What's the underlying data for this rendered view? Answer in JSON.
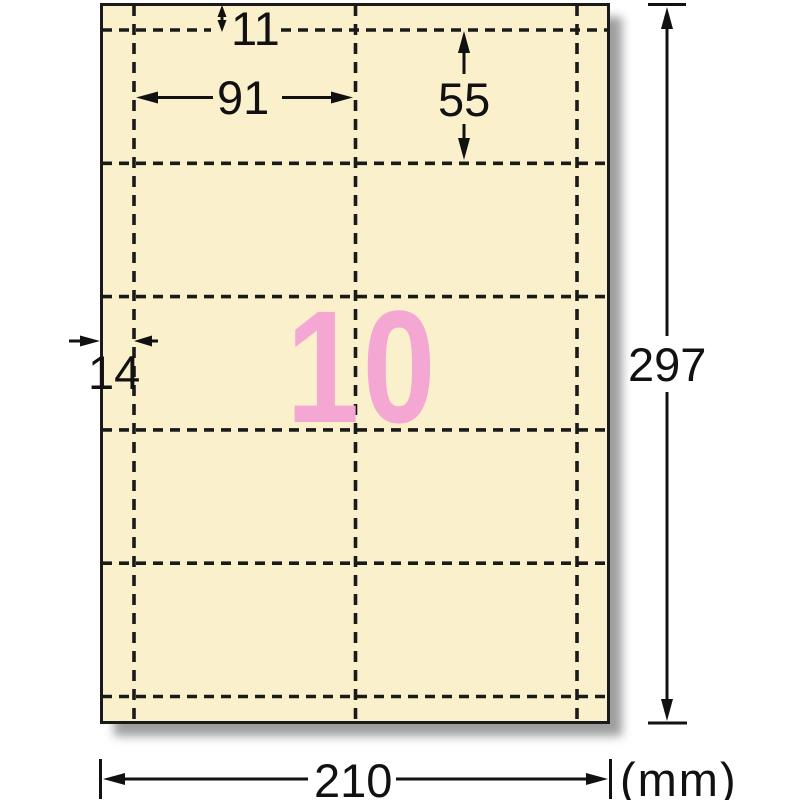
{
  "sheet": {
    "count_label": "10",
    "grid": {
      "columns": 2,
      "rows": 5
    },
    "colors": {
      "sheet_fill": "#FBF0CC",
      "count_pink": "#F3A7D2",
      "line_black": "#1a1a1a"
    }
  },
  "dimensions": {
    "top_margin_mm": "11",
    "card_width_mm": "91",
    "card_height_mm": "55",
    "side_margin_mm": "14",
    "sheet_height_mm": "297",
    "sheet_width_mm": "210",
    "unit": "(mm)"
  }
}
